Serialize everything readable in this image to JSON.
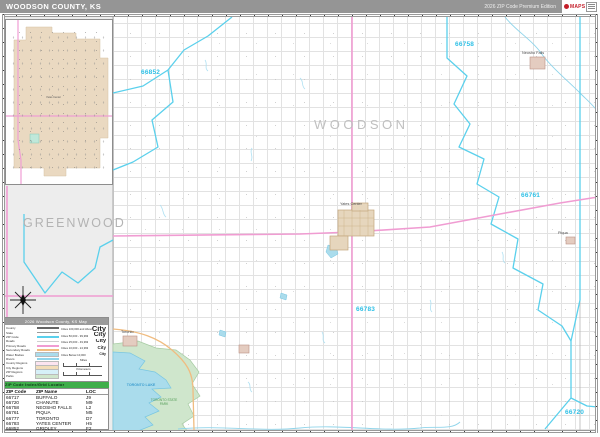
{
  "header": {
    "title": "WOODSON COUNTY, KS",
    "edition": "2026 ZIP Code Premium Edition",
    "logo_brand": "MAPS"
  },
  "map": {
    "county_label": "WOODSON",
    "neighbor_county_label": "GREENWOOD",
    "zip_labels": [
      {
        "code": "66852"
      },
      {
        "code": "66758"
      },
      {
        "code": "66761"
      },
      {
        "code": "66783"
      },
      {
        "code": "66720"
      }
    ],
    "towns": [
      {
        "name": "Yates Center"
      },
      {
        "name": "Toronto"
      },
      {
        "name": "Neosho Falls"
      },
      {
        "name": "Piqua"
      }
    ],
    "water": {
      "lake": "TORONTO LAKE",
      "park": "TORONTO STATE PARK"
    },
    "colors": {
      "zip_boundary": "#5ad0ec",
      "zip_label": "#2fc0e6",
      "primary_road": "#f09cd2",
      "secondary_road": "#f0bc80",
      "water": "#aadcec",
      "park": "#cfe6cc",
      "urban": "#e6d6bd",
      "outside_county": "#ededed",
      "header_bar": "#959595",
      "table_header_bar": "#3fae4a"
    }
  },
  "legend": {
    "title": "2026 Woodson County, KS Map",
    "items": [
      {
        "label": "County",
        "swatch": "line",
        "color": "#666666"
      },
      {
        "label": "State",
        "swatch": "line",
        "color": "#9a9a9a"
      },
      {
        "label": "ZIP Code",
        "swatch": "line",
        "color": "#5ad0ec"
      },
      {
        "label": "Roads",
        "swatch": "line",
        "color": "#cfcfcf"
      },
      {
        "label": "Primary Roads",
        "swatch": "line",
        "color": "#f09cd2"
      },
      {
        "label": "Secondary Roads",
        "swatch": "line",
        "color": "#f0bc80"
      },
      {
        "label": "Water Bodies",
        "swatch": "fill",
        "color": "#aadcec"
      },
      {
        "label": "Rivers",
        "swatch": "line",
        "color": "#8fd4ea"
      },
      {
        "label": "County Regions",
        "swatch": "fill",
        "color": "#fce4f0"
      },
      {
        "label": "City Regions",
        "swatch": "fill",
        "color": "#f3ddb9"
      },
      {
        "label": "ZIP Regions",
        "swatch": "fill",
        "color": "#d6f0f8"
      },
      {
        "label": "Parks",
        "swatch": "fill",
        "color": "#cfe6cc"
      }
    ],
    "city_sizes": [
      {
        "label": "Cities 100,000 and Above",
        "sample": "City",
        "size": 7.5
      },
      {
        "label": "Cities 50,000 - 99,999",
        "sample": "City",
        "size": 6.5
      },
      {
        "label": "Cities 25,000 - 49,999",
        "sample": "City",
        "size": 5.5
      },
      {
        "label": "Cities 10,000 - 24,999",
        "sample": "City",
        "size": 4.5
      },
      {
        "label": "Cities Below 10,000",
        "sample": "City",
        "size": 3.5
      }
    ],
    "scales": [
      "Miles",
      "Kilometers"
    ]
  },
  "table": {
    "header_bar": "ZIP Code Index/Grid Locator",
    "columns": [
      "ZIP Code",
      "ZIP Name",
      "LOC"
    ],
    "rows": [
      [
        "66717",
        "BUFFALO",
        "J9"
      ],
      [
        "66720",
        "CHANUTE",
        "M9"
      ],
      [
        "66758",
        "NEOSHO FALLS",
        "L2"
      ],
      [
        "66761",
        "PIQUA",
        "M5"
      ],
      [
        "66777",
        "TORONTO",
        "D7"
      ],
      [
        "66783",
        "YATES CENTER",
        "H5"
      ],
      [
        "66852",
        "GRIDLEY",
        "F2"
      ]
    ]
  }
}
